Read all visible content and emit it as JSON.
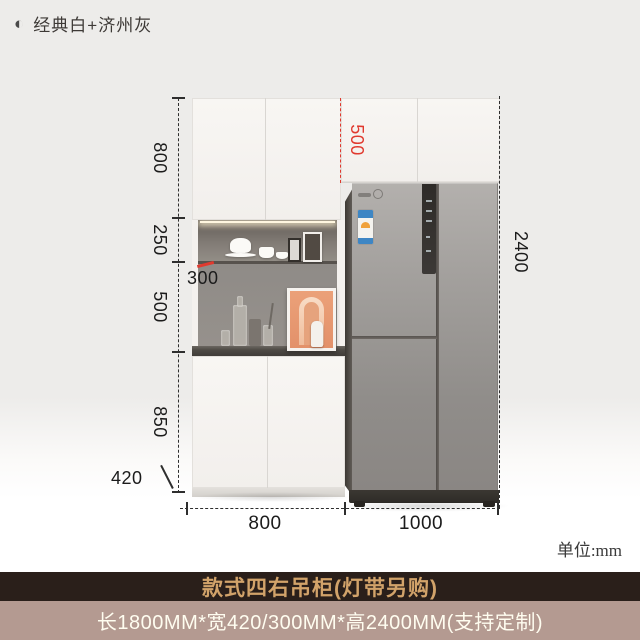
{
  "header": {
    "icon": "half-filled-circle",
    "label": "经典白+济州灰"
  },
  "annotations": {
    "left_heights": [
      "800",
      "250",
      "500",
      "850"
    ],
    "upper_depth": "300",
    "base_depth": "420",
    "fridge_gap_height": "500",
    "total_height": "2400",
    "bottom_widths": [
      "800",
      "1000"
    ],
    "unit_label": "单位:mm"
  },
  "footer": {
    "title": "款式四右吊柜(灯带另购)",
    "specs": "长1800MM*宽420/300MM*高2400MM(支持定制)"
  },
  "colors": {
    "accent_red": "#e0392e",
    "background_gray": "#edecea",
    "banner_title_bg": "#2a1f1a",
    "banner_title_text": "#d2a36a",
    "banner_specs_bg": "#b49a91",
    "banner_specs_text": "#fffdf0"
  }
}
